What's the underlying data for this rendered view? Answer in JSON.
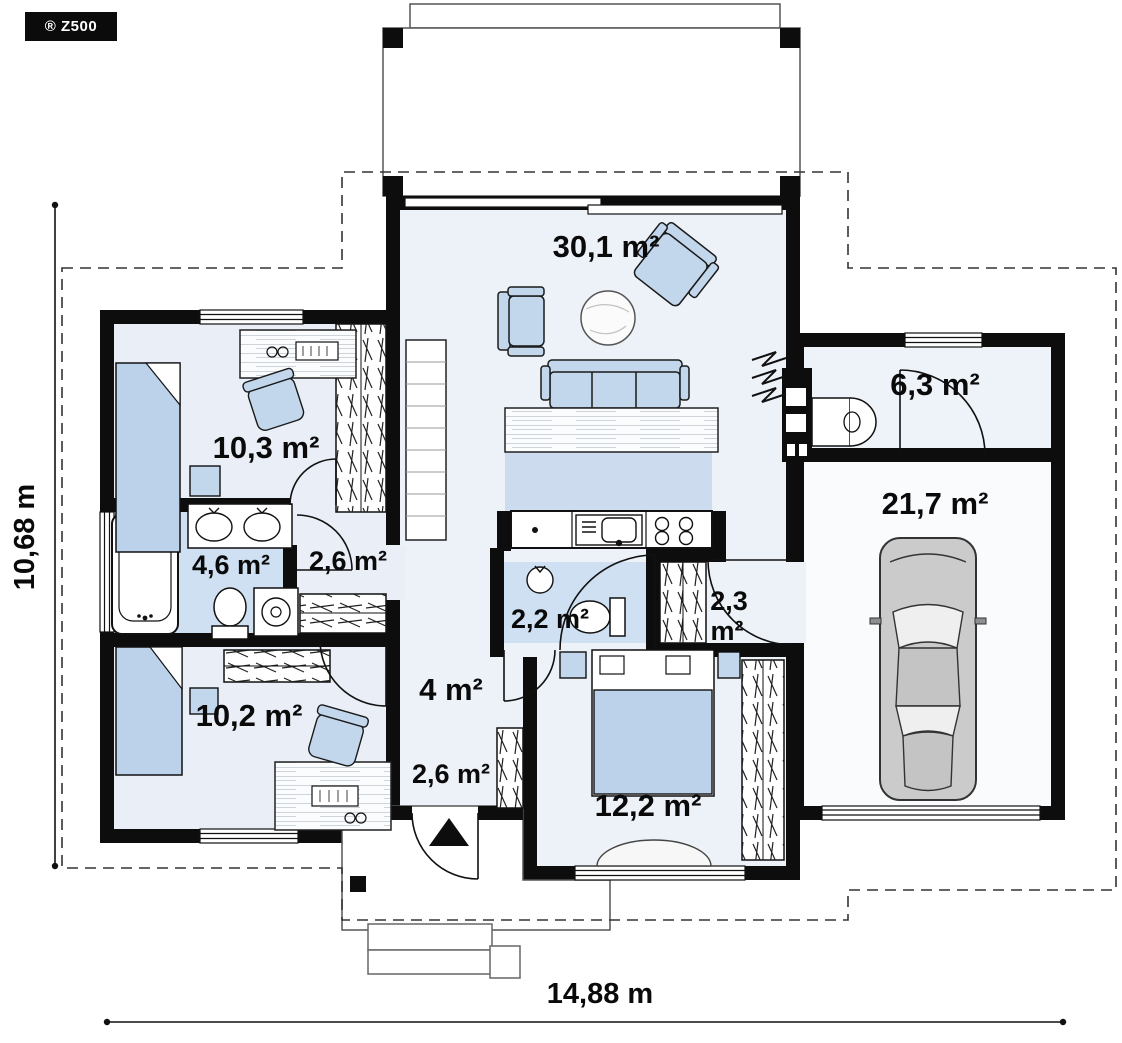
{
  "badge": {
    "brand": "® Z500"
  },
  "plan_title": "Single-storey house floor plan",
  "dimensions": {
    "width_label": "14,88 m",
    "height_label": "10,68 m"
  },
  "rooms": {
    "living": {
      "area": "30,1 m²"
    },
    "bedroom_top": {
      "area": "10,3 m²"
    },
    "bathroom": {
      "area": "4,6 m²"
    },
    "hallway": {
      "area": "2,6 m²"
    },
    "wc": {
      "area": "2,2 m²"
    },
    "wardrobe": {
      "area_value": "2,3",
      "area_unit": "m²"
    },
    "hall": {
      "area": "4 m²"
    },
    "bedroom_left": {
      "area": "10,2 m²"
    },
    "entry": {
      "area": "2,6 m²"
    },
    "bedroom_bottom": {
      "area": "12,2 m²"
    },
    "utility": {
      "area": "6,3 m²"
    },
    "garage": {
      "area": "21,7 m²"
    }
  },
  "colors": {
    "wall": "#0d0d0d",
    "floor": "#e9eef7",
    "wet_floor": "#cfe0f2",
    "kitchen_floor": "#ccdcee",
    "furniture": "#c3d7ec",
    "bed": "#bcd2ea",
    "car_body": "#cbcbcb"
  }
}
